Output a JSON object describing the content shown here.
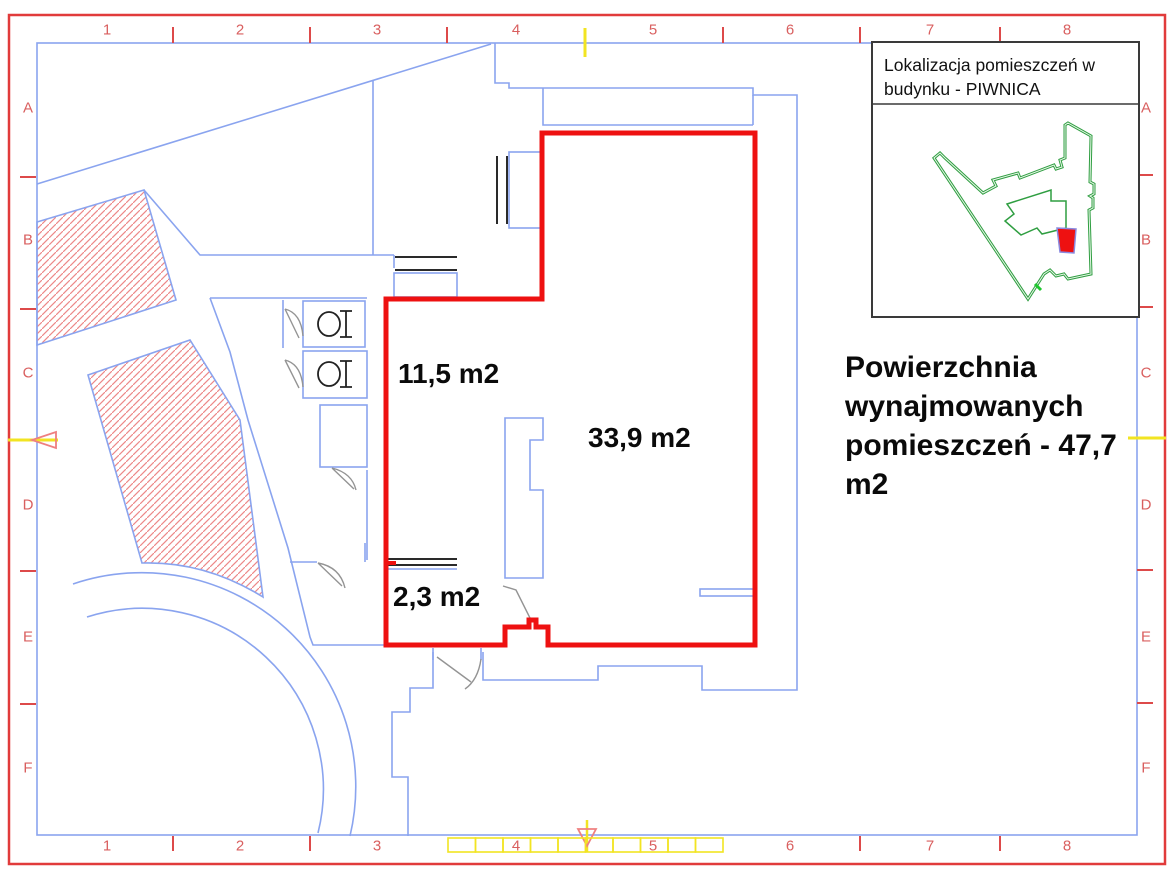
{
  "drawing_frame": {
    "columns": [
      "1",
      "2",
      "3",
      "4",
      "5",
      "6",
      "7",
      "8"
    ],
    "rows": [
      "A",
      "B",
      "C",
      "D",
      "E",
      "F"
    ],
    "label_color": "#d95f5f"
  },
  "legend_box": {
    "title": "Lokalizacja pomieszczeń w budynku - PIWNICA"
  },
  "area_labels": {
    "room_top": "11,5 m2",
    "room_large": "33,9 m2",
    "room_small": "2,3 m2"
  },
  "summary_note": "Powierzchnia wynajmowanych pomieszczeń - 47,7 m2",
  "scale_bar": {
    "segments": 10
  },
  "colors": {
    "walls_blue": "#8aa4ef",
    "highlight_red": "#ee1111",
    "hatch_red": "#ed8888",
    "grid_red": "#dd4a4a",
    "legend_building_green": "#2f9e41",
    "marker_yellow": "#f2e422",
    "door_gray": "#949494",
    "fixture_dark": "#2a2a2a"
  }
}
